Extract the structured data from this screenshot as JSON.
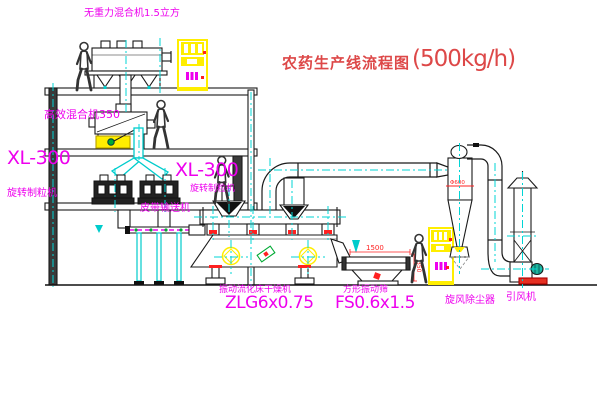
{
  "title": {
    "text": "农药生产线流程图",
    "capacity": "(500kg/h)"
  },
  "machines": {
    "top_mixer": "无重力混合机1.5立方",
    "mid_mixer": "高效混合机350",
    "granulator_left": {
      "model": "XL-300",
      "name": "旋转制粒机"
    },
    "granulator_right": {
      "model": "XL-300",
      "name": "旋转制粒机"
    },
    "belt_conveyor": "皮带输送机",
    "dryer": {
      "name": "振动流化床干燥机",
      "model": "ZLG6x0.75"
    },
    "screen": {
      "name": "方形振动筛",
      "model": "FS0.6x1.5"
    },
    "cyclone": "旋风除尘器",
    "fan": "引风机"
  },
  "dimensions": {
    "screen_length": "1500",
    "screen_height": "350",
    "cyclone_diameter": "Φ600"
  },
  "colors": {
    "label_magenta": "#ee00ee",
    "title_red": "#dd4848",
    "dim_red": "#ff2020",
    "centerline_cyan": "#00d5d5",
    "equipment_yellow": "#ffee00",
    "outline_black": "#1a1a1a",
    "motor_green": "#20b39b"
  }
}
